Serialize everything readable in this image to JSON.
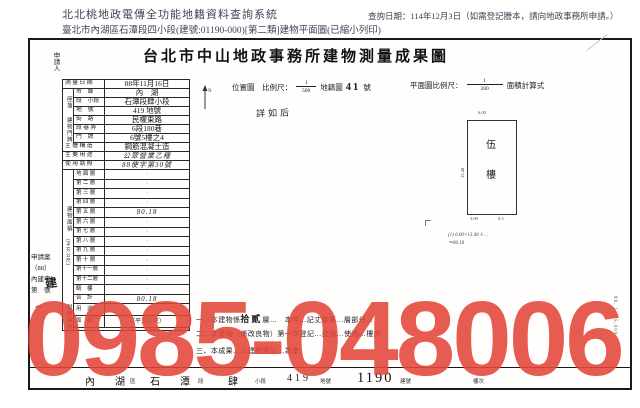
{
  "header": {
    "system_title": "北北桃地政電傳全功能地籍資料查詢系統",
    "query_date": "查詢日期：114年12月3日（如需登記謄本，請向地政事務所申請。）",
    "doc_line": "臺北市內湖區石潭段四小段(建號:01190-000)[第二類]建物平面圖(已縮小列印)"
  },
  "document": {
    "title": "台北市中山地政事務所建物測量成果圖",
    "applicant_label": "申請人"
  },
  "table": {
    "survey": {
      "l": "測 量 日 期",
      "v": "88年11月16日"
    },
    "g_loc": "座落",
    "loc": [
      {
        "l": "市　鄉",
        "v": "內　湖"
      },
      {
        "l": "段　小段",
        "v": "石潭段肆小段"
      },
      {
        "l": "地　號",
        "v": "419 地號"
      }
    ],
    "g_addr": "建物門牌",
    "addr": [
      {
        "l": "街　路",
        "v": "民權東路"
      },
      {
        "l": "段 巷 弄",
        "v": "6段180巷"
      },
      {
        "l": "門　牌",
        "v": "6號5樓之4"
      }
    ],
    "struct": {
      "l": "主 體 構 造",
      "v": "鋼筋混凝土造"
    },
    "use": {
      "l": "主 要 用 途",
      "v": "公眾營業乙種"
    },
    "lic": {
      "l": "使 用 執 照",
      "v": "88使字第30號"
    },
    "g_area": "建物面積",
    "area_unit": "（平方公尺）",
    "floors": [
      {
        "l": "地 面 層",
        "v": "·"
      },
      {
        "l": "第 二 層",
        "v": "·"
      },
      {
        "l": "第 三 層",
        "v": "·"
      },
      {
        "l": "第 四 層",
        "v": "·"
      },
      {
        "l": "第 五 層",
        "v": "80.18"
      },
      {
        "l": "第 六 層",
        "v": "·"
      },
      {
        "l": "第 七 層",
        "v": "·"
      },
      {
        "l": "第 八 層",
        "v": "·"
      },
      {
        "l": "第 九 層",
        "v": "·"
      },
      {
        "l": "第 十 層",
        "v": "·"
      },
      {
        "l": "第十一層",
        "v": "·"
      },
      {
        "l": "第十二層",
        "v": "·"
      },
      {
        "l": "騎　樓",
        "v": "·"
      },
      {
        "l": "合　計",
        "v": "80.18"
      }
    ],
    "g_acc": "附屬建物",
    "acc": [
      {
        "l": "用　途",
        "v": ""
      },
      {
        "l": "面　積",
        "v": "（平方公尺）"
      }
    ]
  },
  "plan": {
    "loc_label": "位置圖　比例尺：",
    "loc_num": "1",
    "loc_den": "500",
    "map_label": "地籍圖",
    "map_no": "41",
    "map_unit": "號",
    "north": "N",
    "detail_note": "詳如后",
    "scale_label": "平面圖比例尺：",
    "scale_num": "1",
    "scale_den": "200",
    "calc_label": "面積計算式",
    "floor_char_top": "伍",
    "floor_char_bottom": "樓",
    "dim_top": "6.00",
    "dim_left": "13.40",
    "dim_b1": "3.00",
    "dim_b2": "0.5",
    "calc_line1": "(1) 6.00×13.40＋…",
    "calc_line2": "＝80.18"
  },
  "notes": {
    "l1a": "一、本建物係",
    "l1b": "拾貳",
    "l1c": "層…　本件…記丈量第…層部分…",
    "l2": "二、本建物（係改良物）第一次登記…建物…使用…樓房…",
    "l3": "三、本成果…以建物登記…為準。"
  },
  "case_no": {
    "c1": "申請案",
    "c2": "（88）",
    "c3": "內建字",
    "c4": "第　號",
    "hand": "建",
    "scribble": "〜"
  },
  "bottom_strip": {
    "d1": "內　湖",
    "s1": "區",
    "d2": "石　潭",
    "s2": "段",
    "d3": "肆",
    "s3": "小段",
    "d4": "419",
    "s4": "地號",
    "d5": "1190",
    "s5": "建號",
    "s6": "樓次"
  },
  "stamp": {
    "text": "0985-048006",
    "color": "#e4463a"
  },
  "side_code": "88. 1. 15,000"
}
